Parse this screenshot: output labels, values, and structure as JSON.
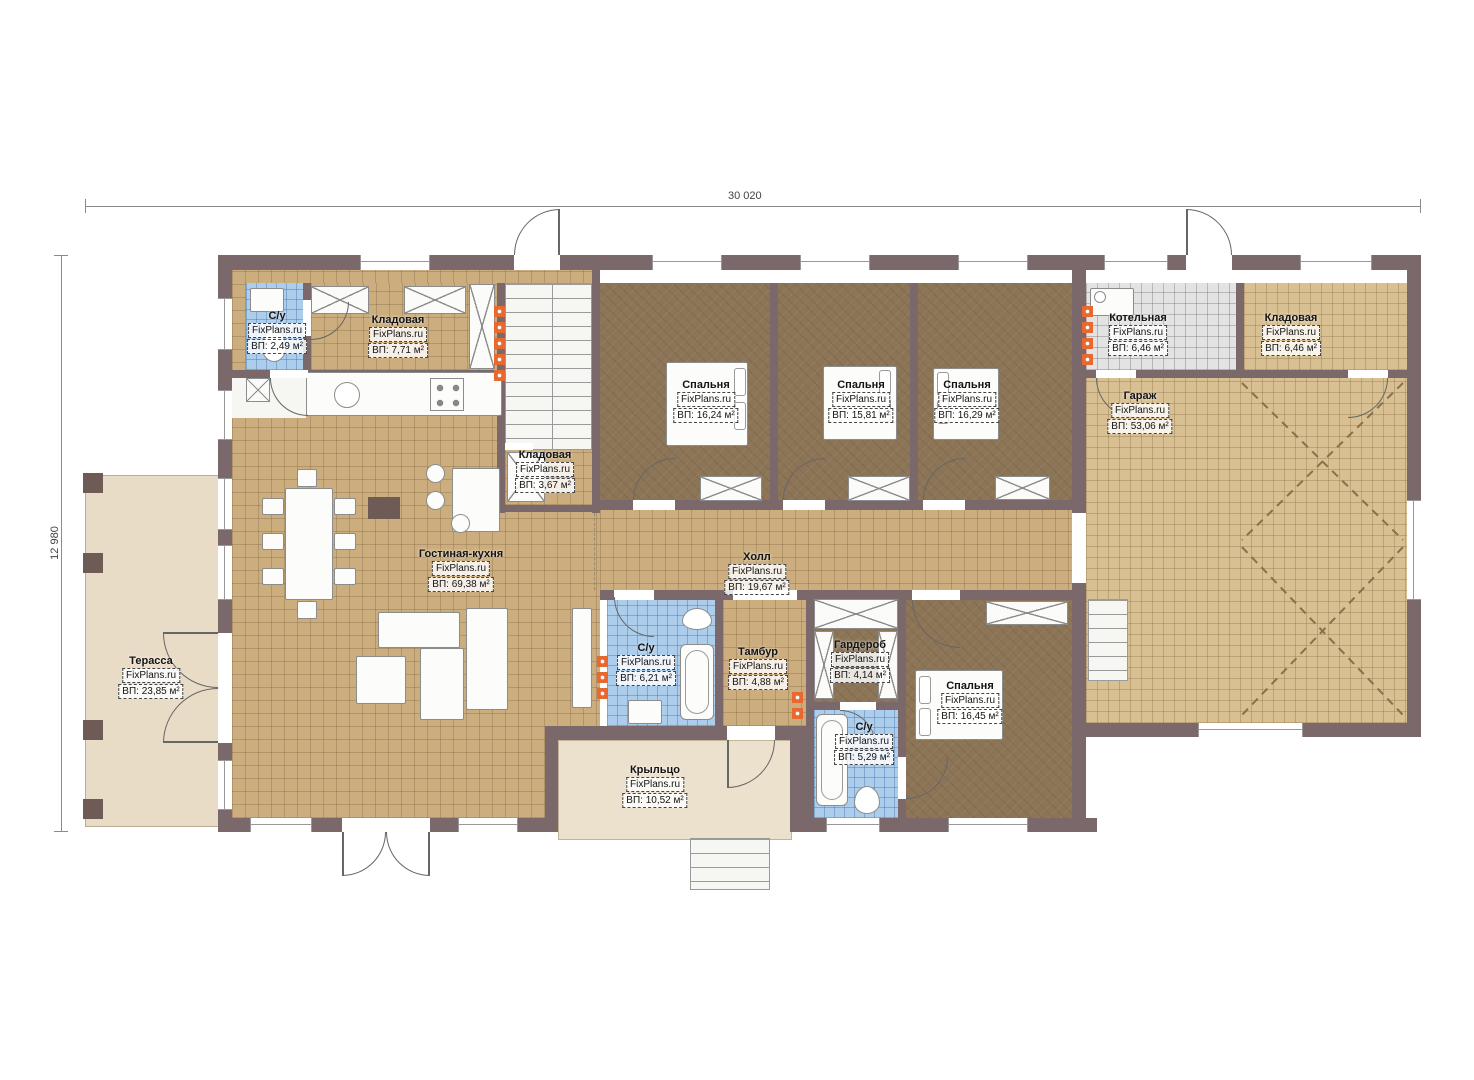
{
  "dimensions": {
    "top": "30 020",
    "left": "12 980"
  },
  "watermark": "FixPlans.ru",
  "colors": {
    "wall": "#7b686a",
    "tile_light": "#cbad7e",
    "tile_dark": "#8c7456",
    "tile_garage": "#d8c093",
    "tile_gray": "#e3e3e3",
    "tile_blue": "#accdeb",
    "terrace": "#e9dcc7",
    "porch": "#ece1cd",
    "radiator": "#e8692f"
  },
  "rooms": [
    {
      "name": "С/у",
      "area": "ВП: 2,49 м²"
    },
    {
      "name": "Кладовая",
      "area": "ВП: 7,71 м²"
    },
    {
      "name": "Кладовая",
      "area": "ВП: 3,67 м²"
    },
    {
      "name": "Спальня",
      "area": "ВП: 16,24 м²"
    },
    {
      "name": "Спальня",
      "area": "ВП: 15,81 м²"
    },
    {
      "name": "Спальня",
      "area": "ВП: 16,29 м²"
    },
    {
      "name": "Котельная",
      "area": "ВП: 6,46 м²"
    },
    {
      "name": "Кладовая",
      "area": "ВП: 6,46 м²"
    },
    {
      "name": "Гараж",
      "area": "ВП: 53,06 м²"
    },
    {
      "name": "Гостиная-кухня",
      "area": "ВП: 69,38 м²"
    },
    {
      "name": "Холл",
      "area": "ВП: 19,67 м²"
    },
    {
      "name": "Терасса",
      "area": "ВП: 23,85 м²"
    },
    {
      "name": "С/у",
      "area": "ВП: 6,21 м²"
    },
    {
      "name": "Тамбур",
      "area": "ВП: 4,88 м²"
    },
    {
      "name": "Гардероб",
      "area": "ВП: 4,14 м²"
    },
    {
      "name": "С/у",
      "area": "ВП: 5,29 м²"
    },
    {
      "name": "Спальня",
      "area": "ВП: 16,45 м²"
    },
    {
      "name": "Крыльцо",
      "area": "ВП: 10,52 м²"
    }
  ]
}
